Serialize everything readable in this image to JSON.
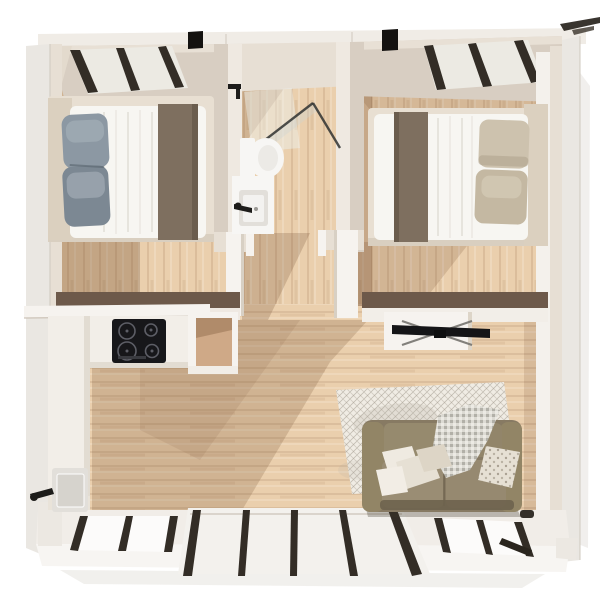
{
  "scene": {
    "description": "top-down 3d architectural render of a small two-bedroom home floor plan",
    "rooms": [
      {
        "name": "bedroom-left",
        "furniture": [
          "double-bed",
          "headboard",
          "blue-gray-pillows",
          "taupe-throw-blanket"
        ]
      },
      {
        "name": "bathroom",
        "furniture": [
          "glass-shower",
          "toilet",
          "vanity-sink"
        ]
      },
      {
        "name": "bedroom-right",
        "furniture": [
          "double-bed",
          "headboard",
          "beige-pillows",
          "taupe-throw-blanket"
        ]
      },
      {
        "name": "kitchen",
        "furniture": [
          "wall-shelf",
          "counter-run",
          "induction-cooktop",
          "open-cabinet",
          "kitchen-sink",
          "black-faucet"
        ]
      },
      {
        "name": "living-room",
        "furniture": [
          "olive-sofa",
          "scatter-pillows",
          "sparkle-throw",
          "area-rug",
          "tv",
          "tv-console"
        ]
      },
      {
        "name": "hallway",
        "furniture": []
      }
    ],
    "openings": [
      "window-top-left",
      "window-top-right",
      "window-bottom-left",
      "sliding-patio-door",
      "window-bottom-right",
      "bathroom-door",
      "bedroom-left-door",
      "bedroom-right-door"
    ]
  },
  "palette": {
    "background": "#ffffff",
    "wall_face": "#d8cec2",
    "wall_face_light": "#e7dfd4",
    "wall_top": "#f0ece6",
    "wall_outer": "#eae7e2",
    "wall_white": "#f6f3ef",
    "wood_cap": "#6d594a",
    "floor": "#eacfad",
    "shadow_tint": "#6b4527",
    "window_frame": "#332d26",
    "black_metal": "#141210",
    "glass_pane": "#eceae3",
    "bed_platform": "#e8dfd2",
    "headboard": "#dbd0bf",
    "bed_white": "#f7f6f2",
    "blanket_taupe": "#7e6f5f",
    "blanket_dark": "#6b5d4e",
    "pillow_blue": "#8c98a3",
    "pillow_blue_dark": "#7c8893",
    "pillow_blue_light": "#a2adb5",
    "pillow_beige": "#cdc2ae",
    "pillow_beige_dark": "#c4b8a2",
    "sofa_body": "#877a63",
    "sofa_arm": "#928566",
    "sofa_back": "#968a6e",
    "sofa_cushion": "#9a8d74",
    "sofa_front_dark": "#6e634e",
    "pillow_white": "#efeae1",
    "pillow_cream": "#e6e0d4",
    "rug": "#f0ece4",
    "counter": "#f2eee8",
    "counter_edge": "#e2dcd2",
    "cooktop": "#17171a",
    "fixture_white": "#f7f6f4",
    "basin_grey": "#e2dfda",
    "cabinet_wood": "#cfa987",
    "tv_black": "#151517",
    "faucet_black": "#1d1c1a"
  }
}
